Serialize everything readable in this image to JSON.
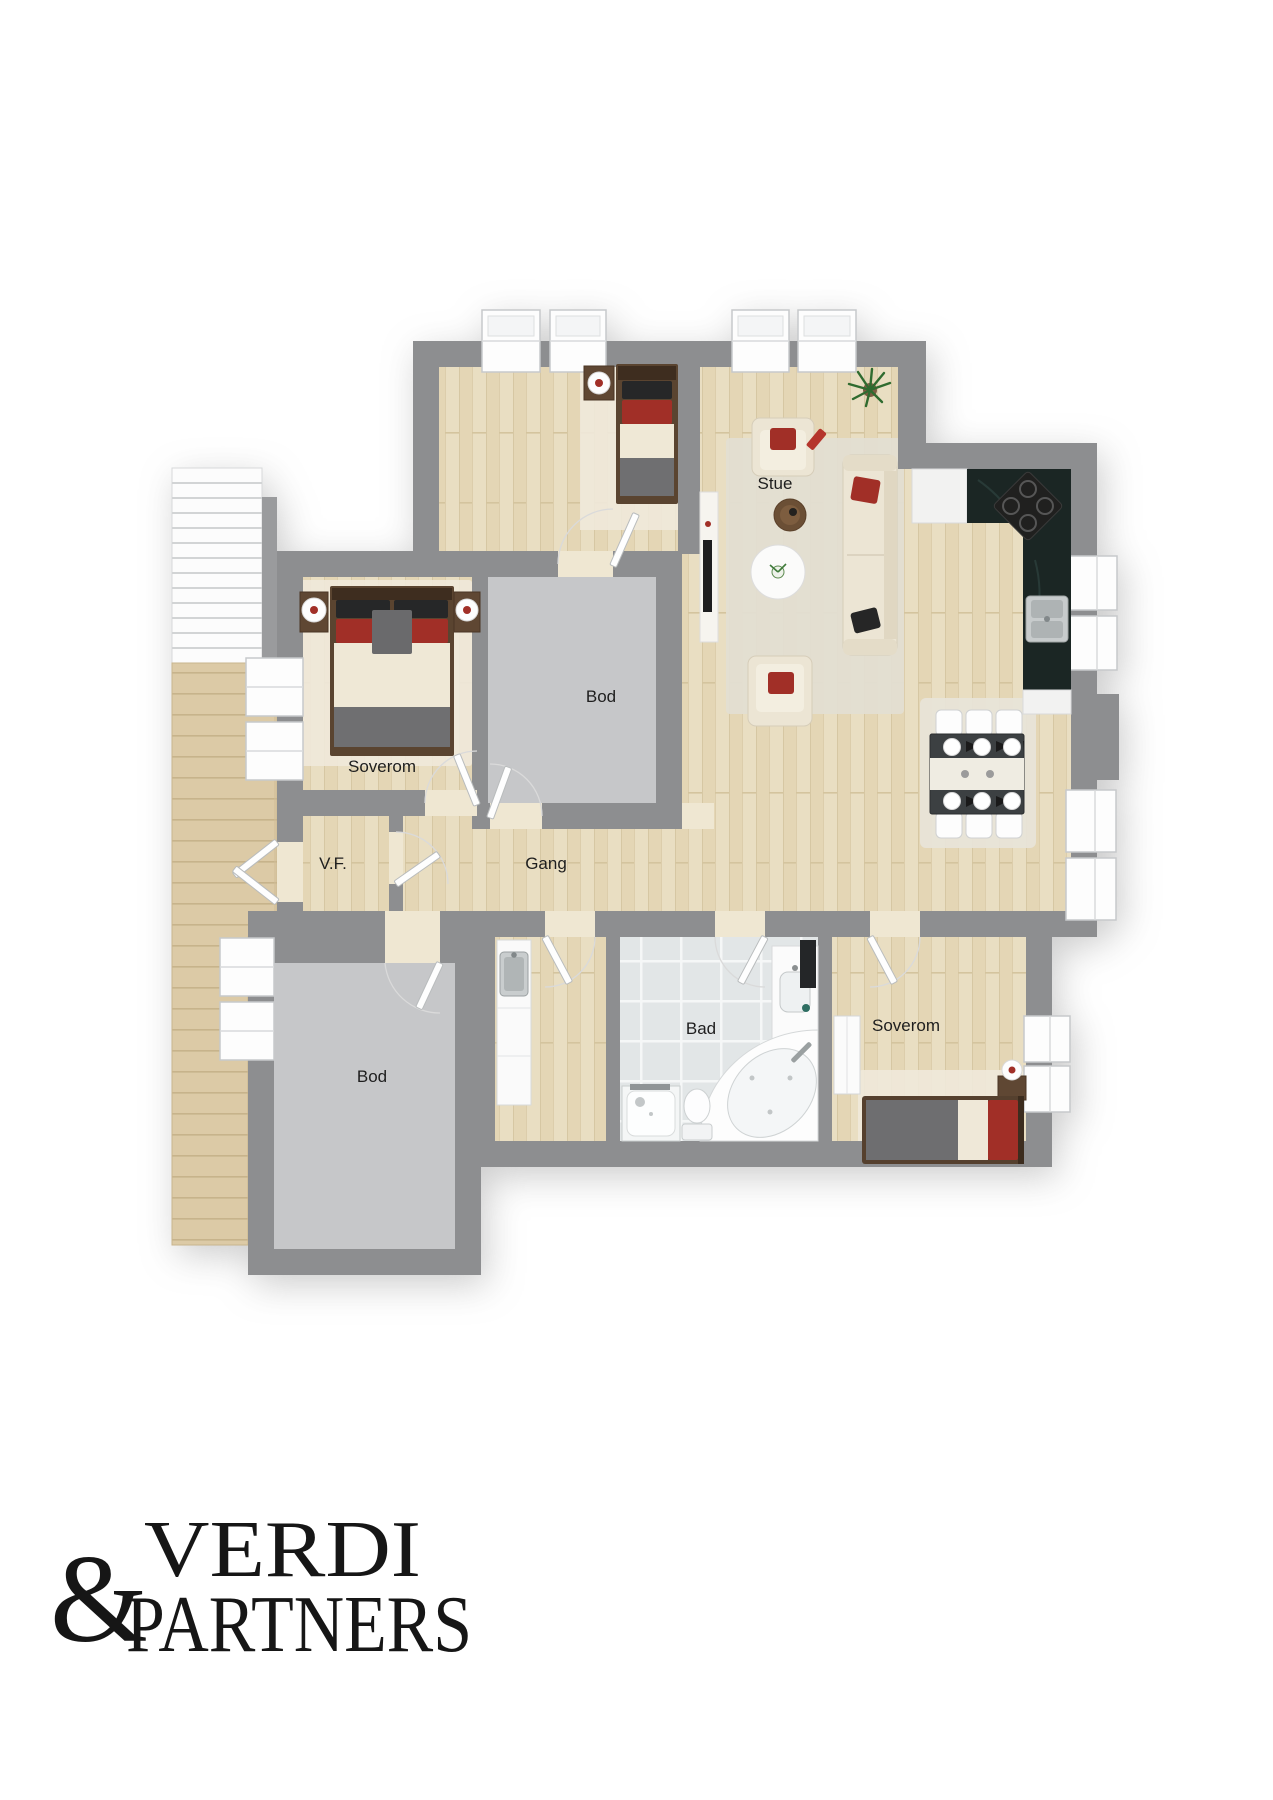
{
  "floorplan": {
    "labels": {
      "stue": "Stue",
      "bod_mid": "Bod",
      "soverom_master": "Soverom",
      "vf": "V.F.",
      "gang": "Gang",
      "bad": "Bad",
      "soverom_south": "Soverom",
      "bod_south": "Bod"
    },
    "colors": {
      "wall": "#8d8e90",
      "wood_floor": "#e8ddc1",
      "deck_wood": "#dccaa6",
      "storage_floor": "#c6c7c9",
      "bath_tile": "#e2e6e7",
      "kitchen_counter": "#1b2624",
      "accent_red": "#a12f27",
      "furniture_cream": "#ece5d4",
      "blanket_gray": "#6f6f71",
      "wood_furniture": "#5a4430"
    }
  },
  "logo": {
    "ampersand": "&",
    "line1": "VERDI",
    "line2": "PARTNERS"
  }
}
